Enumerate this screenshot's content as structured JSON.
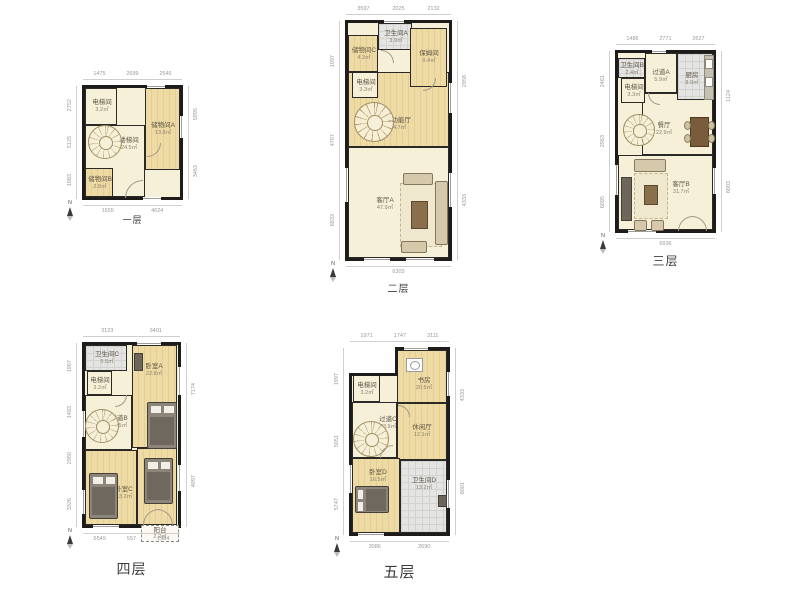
{
  "page": {
    "title": "户型图",
    "floor_count": 5
  },
  "compass_label": "N",
  "palette": {
    "wall": "#1e1c1a",
    "wood": "#eedaa5",
    "cream": "#f7f0d9",
    "tile": "#e4e4e2",
    "room_text": "#5e5646",
    "dim_text": "#9a9a98"
  },
  "floors": [
    {
      "id": "floor-1",
      "title": "一层",
      "title_style": {
        "dy": 16,
        "size": 9
      },
      "box": {
        "left": 85,
        "top": 88,
        "width": 95,
        "height": 109
      },
      "rooms": [
        {
          "key": "elevator-room",
          "name": "电梯间",
          "area": "3.2㎡",
          "x": 0,
          "y": 0,
          "w": 32,
          "h": 37,
          "fill": "cream",
          "lx": 16,
          "ly": 17
        },
        {
          "key": "storage-room-a",
          "name": "储物间A",
          "area": "13.8㎡",
          "x": 60,
          "y": 0,
          "w": 35,
          "h": 82,
          "fill": "wood",
          "lx": 77,
          "ly": 40
        },
        {
          "key": "stair-hall",
          "name": "楼梯间",
          "area": "24.5㎡",
          "x": 0,
          "y": 37,
          "w": 60,
          "h": 72,
          "fill": "cream",
          "lx": 43,
          "ly": 55
        },
        {
          "key": "storage-room-b",
          "name": "储物间B",
          "area": "2.8㎡",
          "x": 0,
          "y": 80,
          "w": 28,
          "h": 29,
          "fill": "wood",
          "lx": 14,
          "ly": 94
        }
      ],
      "stairs": {
        "cx": 19,
        "cy": 53,
        "r": 16
      },
      "furniture": [],
      "arcs": [
        {
          "x": 40,
          "y": 92,
          "r": 17,
          "rot": 0
        },
        {
          "x": 62,
          "y": 55,
          "r": 13,
          "rot": 180
        }
      ],
      "windows": [
        {
          "s": "top",
          "p": 62,
          "l": 18
        },
        {
          "s": "right",
          "p": 28,
          "l": 22
        },
        {
          "s": "bottom",
          "p": 58,
          "l": 18
        }
      ],
      "dims": {
        "top": [
          "1475",
          "2699",
          "2546"
        ],
        "bottom": [
          "1655",
          "4624"
        ],
        "left": [
          "2752",
          "5125",
          "1983"
        ],
        "right": [
          "5995",
          "3463"
        ]
      }
    },
    {
      "id": "floor-2",
      "title": "二层",
      "title_style": {
        "dy": 22,
        "size": 10
      },
      "box": {
        "left": 348,
        "top": 23,
        "width": 101,
        "height": 235
      },
      "rooms": [
        {
          "key": "multi-function-hall",
          "name": "多功能厅",
          "area": "34.7㎡",
          "x": 0,
          "y": 49,
          "w": 101,
          "h": 75,
          "fill": "wood",
          "lx": 49,
          "ly": 100
        },
        {
          "key": "living-room-a",
          "name": "客厅A",
          "area": "47.9㎡",
          "x": 0,
          "y": 124,
          "w": 101,
          "h": 111,
          "fill": "cream",
          "lx": 36,
          "ly": 180
        },
        {
          "key": "storage-room-c",
          "name": "储物间C",
          "area": "4.3㎡",
          "x": 0,
          "y": 12,
          "w": 30,
          "h": 37,
          "fill": "wood",
          "lx": 15,
          "ly": 30
        },
        {
          "key": "bathroom-a",
          "name": "卫生间A",
          "area": "3.9㎡",
          "x": 30,
          "y": 0,
          "w": 34,
          "h": 27,
          "fill": "tile",
          "lx": 47,
          "ly": 13
        },
        {
          "key": "nanny-room",
          "name": "保姆间",
          "area": "9.4㎡",
          "x": 62,
          "y": 5,
          "w": 37,
          "h": 59,
          "fill": "wood",
          "lx": 80,
          "ly": 33
        },
        {
          "key": "elevator-room",
          "name": "电梯间",
          "area": "3.3㎡",
          "x": 4,
          "y": 49,
          "w": 26,
          "h": 26,
          "fill": "cream",
          "lx": 17,
          "ly": 62
        }
      ],
      "stairs": {
        "cx": 25,
        "cy": 98,
        "r": 19
      },
      "furniture": [
        {
          "t": "rug",
          "x": 52,
          "y": 160,
          "w": 40,
          "h": 62
        },
        {
          "t": "sofa",
          "x": 55,
          "y": 150,
          "w": 28,
          "h": 10
        },
        {
          "t": "sofa",
          "x": 87,
          "y": 158,
          "w": 11,
          "h": 62
        },
        {
          "t": "sofa",
          "x": 53,
          "y": 218,
          "w": 24,
          "h": 10
        },
        {
          "t": "ctable",
          "x": 63,
          "y": 178,
          "w": 15,
          "h": 26
        }
      ],
      "arcs": [
        {
          "x": 33,
          "y": 27,
          "r": 12,
          "rot": 90
        },
        {
          "x": 75,
          "y": 55,
          "r": 12,
          "rot": 180
        }
      ],
      "windows": [
        {
          "s": "bottom",
          "p": 16,
          "l": 26
        },
        {
          "s": "bottom",
          "p": 58,
          "l": 28
        },
        {
          "s": "left",
          "p": 145,
          "l": 34
        },
        {
          "s": "right",
          "p": 60,
          "l": 30
        },
        {
          "s": "right",
          "p": 150,
          "l": 34
        },
        {
          "s": "top",
          "p": 36,
          "l": 20
        }
      ],
      "dims": {
        "top": [
          "3597",
          "2025",
          "2132"
        ],
        "bottom": [
          "6303"
        ],
        "left": [
          "1997",
          "4767",
          "6833"
        ],
        "right": [
          "2958",
          "4333"
        ]
      }
    },
    {
      "id": "floor-3",
      "title": "三层",
      "title_style": {
        "dy": 22,
        "size": 12
      },
      "box": {
        "left": 618,
        "top": 53,
        "width": 95,
        "height": 177
      },
      "rooms": [
        {
          "key": "dining-room",
          "name": "餐厅",
          "area": "22.9㎡",
          "x": 24,
          "y": 40,
          "w": 71,
          "h": 62,
          "fill": "cream",
          "lx": 45,
          "ly": 75
        },
        {
          "key": "living-room-b",
          "name": "客厅B",
          "area": "31.7㎡",
          "x": 0,
          "y": 102,
          "w": 95,
          "h": 75,
          "fill": "cream",
          "lx": 62,
          "ly": 134
        },
        {
          "key": "bathroom-b",
          "name": "卫生间B",
          "area": "2.4㎡",
          "x": 0,
          "y": 5,
          "w": 27,
          "h": 20,
          "fill": "tile",
          "lx": 13,
          "ly": 15
        },
        {
          "key": "corridor-a",
          "name": "过道A",
          "area": "5.9㎡",
          "x": 27,
          "y": 0,
          "w": 32,
          "h": 40,
          "fill": "cream",
          "lx": 42,
          "ly": 22
        },
        {
          "key": "kitchen",
          "name": "厨房",
          "area": "8.9㎡",
          "x": 59,
          "y": 0,
          "w": 36,
          "h": 47,
          "fill": "tile",
          "lx": 73,
          "ly": 25
        },
        {
          "key": "elevator-room",
          "name": "电梯间",
          "area": "3.3㎡",
          "x": 3,
          "y": 25,
          "w": 24,
          "h": 25,
          "fill": "cream",
          "lx": 15,
          "ly": 37
        }
      ],
      "stairs": {
        "cx": 20,
        "cy": 76,
        "r": 15
      },
      "furniture": [
        {
          "t": "counter",
          "x": 86,
          "y": 2,
          "w": 8,
          "h": 43
        },
        {
          "t": "appl",
          "x": 87,
          "y": 6,
          "w": 6,
          "h": 8
        },
        {
          "t": "appl",
          "x": 87,
          "y": 24,
          "w": 6,
          "h": 8
        },
        {
          "t": "dtable",
          "x": 72,
          "y": 64,
          "w": 17,
          "h": 28
        },
        {
          "t": "chair",
          "x": 66,
          "y": 68,
          "w": 5,
          "h": 7
        },
        {
          "t": "chair",
          "x": 66,
          "y": 81,
          "w": 5,
          "h": 7
        },
        {
          "t": "chair",
          "x": 90,
          "y": 68,
          "w": 5,
          "h": 7
        },
        {
          "t": "chair",
          "x": 90,
          "y": 81,
          "w": 5,
          "h": 7
        },
        {
          "t": "sofa",
          "x": 16,
          "y": 106,
          "w": 30,
          "h": 11
        },
        {
          "t": "rug",
          "x": 16,
          "y": 120,
          "w": 32,
          "h": 44
        },
        {
          "t": "ctable",
          "x": 26,
          "y": 132,
          "w": 12,
          "h": 18
        },
        {
          "t": "sofa",
          "x": 16,
          "y": 167,
          "w": 11,
          "h": 9
        },
        {
          "t": "sofa",
          "x": 33,
          "y": 167,
          "w": 11,
          "h": 9
        },
        {
          "t": "media",
          "x": 3,
          "y": 124,
          "w": 9,
          "h": 42
        }
      ],
      "arcs": [
        {
          "x": 60,
          "y": 163,
          "r": 14,
          "rot": 0
        },
        {
          "x": 74,
          "y": 163,
          "r": 14,
          "rot": 90
        },
        {
          "x": 30,
          "y": 40,
          "r": 11,
          "rot": 270
        }
      ],
      "windows": [
        {
          "s": "top",
          "p": 34,
          "l": 14
        },
        {
          "s": "bottom",
          "p": 10,
          "l": 28
        },
        {
          "s": "left",
          "p": 112,
          "l": 30
        },
        {
          "s": "right",
          "p": 115,
          "l": 26
        }
      ],
      "dims": {
        "top": [
          "1486",
          "2771",
          "2627"
        ],
        "bottom": [
          "6936"
        ],
        "left": [
          "2461",
          "2963",
          "6095"
        ],
        "right": [
          "1124",
          "8003"
        ]
      }
    },
    {
      "id": "floor-4",
      "title": "四层",
      "title_style": {
        "dy": 34,
        "size": 14
      },
      "box": {
        "left": 85,
        "top": 345,
        "width": 93,
        "height": 180
      },
      "rooms": [
        {
          "key": "bedroom-a",
          "name": "卧室A",
          "area": "22.8㎡",
          "x": 47,
          "y": 0,
          "w": 45,
          "h": 103,
          "fill": "wood",
          "lx": 68,
          "ly": 24
        },
        {
          "key": "corridor-b",
          "name": "过道B",
          "area": "24.5㎡",
          "x": 0,
          "y": 50,
          "w": 47,
          "h": 55,
          "fill": "cream",
          "lx": 33,
          "ly": 76
        },
        {
          "key": "bedroom-c",
          "name": "卧室C",
          "area": "13.2㎡",
          "x": 0,
          "y": 105,
          "w": 52,
          "h": 75,
          "fill": "wood",
          "lx": 38,
          "ly": 147
        },
        {
          "key": "bedroom-b",
          "name": "卧室B",
          "area": "13.4㎡",
          "x": 52,
          "y": 103,
          "w": 40,
          "h": 77,
          "fill": "wood",
          "lx": 70,
          "ly": 121
        },
        {
          "key": "bathroom-c",
          "name": "卫生间C",
          "area": "5.5㎡",
          "x": 0,
          "y": 0,
          "w": 42,
          "h": 26,
          "fill": "tile",
          "lx": 21,
          "ly": 12
        },
        {
          "key": "elevator-room",
          "name": "电梯间",
          "area": "3.2㎡",
          "x": 2,
          "y": 26,
          "w": 25,
          "h": 24,
          "fill": "cream",
          "lx": 14,
          "ly": 38
        }
      ],
      "stairs": {
        "cx": 16,
        "cy": 80,
        "r": 16
      },
      "furniture": [
        {
          "t": "bed",
          "o": "v",
          "x": 62,
          "y": 57,
          "w": 28,
          "h": 45
        },
        {
          "t": "bed",
          "o": "v",
          "x": 4,
          "y": 128,
          "w": 27,
          "h": 44
        },
        {
          "t": "bed",
          "o": "v",
          "x": 59,
          "y": 113,
          "w": 27,
          "h": 44
        },
        {
          "t": "media",
          "x": 49,
          "y": 8,
          "w": 7,
          "h": 16
        }
      ],
      "balcony": {
        "name": "阳台",
        "area": "2.2㎡",
        "x": 56,
        "y": 180,
        "w": 36,
        "h": 15
      },
      "arcs": [
        {
          "x": 58,
          "y": 164,
          "r": 15,
          "rot": 0
        },
        {
          "x": 72,
          "y": 164,
          "r": 15,
          "rot": 90
        },
        {
          "x": 30,
          "y": 50,
          "r": 11,
          "rot": 180
        }
      ],
      "windows": [
        {
          "s": "top",
          "p": 52,
          "l": 24
        },
        {
          "s": "left",
          "p": 66,
          "l": 26
        },
        {
          "s": "left",
          "p": 145,
          "l": 24
        },
        {
          "s": "right",
          "p": 22,
          "l": 28
        },
        {
          "s": "right",
          "p": 120,
          "l": 26
        },
        {
          "s": "bottom",
          "p": 8,
          "l": 26
        }
      ],
      "dims": {
        "top": [
          "3123",
          "3401"
        ],
        "bottom": [
          "5549",
          "557",
          "1984"
        ],
        "left": [
          "1967",
          "1483",
          "2960",
          "3326"
        ],
        "right": [
          "7174",
          "4997"
        ]
      }
    },
    {
      "id": "floor-5",
      "title": "五层",
      "title_style": {
        "dy": 28,
        "size": 15
      },
      "box": {
        "left": 352,
        "top": 350,
        "width": 95,
        "height": 183
      },
      "rooms": [
        {
          "key": "study-room",
          "name": "书房",
          "area": "20.5㎡",
          "x": 45,
          "y": 0,
          "w": 50,
          "h": 53,
          "fill": "wood",
          "lx": 71,
          "ly": 33
        },
        {
          "key": "lounge",
          "name": "休闲厅",
          "area": "12.1㎡",
          "x": 45,
          "y": 53,
          "w": 50,
          "h": 57,
          "fill": "wood",
          "lx": 69,
          "ly": 80
        },
        {
          "key": "corridor-c",
          "name": "过道C",
          "area": "23.9㎡",
          "x": 0,
          "y": 52,
          "w": 45,
          "h": 56,
          "fill": "cream",
          "lx": 35,
          "ly": 72
        },
        {
          "key": "bedroom-d",
          "name": "卧室D",
          "area": "16.5㎡",
          "x": 0,
          "y": 108,
          "w": 48,
          "h": 75,
          "fill": "wood",
          "lx": 25,
          "ly": 125
        },
        {
          "key": "bathroom-d",
          "name": "卫生间D",
          "area": "13.2㎡",
          "x": 48,
          "y": 110,
          "w": 47,
          "h": 73,
          "fill": "tile",
          "lx": 71,
          "ly": 133
        },
        {
          "key": "elevator-room",
          "name": "电梯间",
          "area": "3.2㎡",
          "x": 1,
          "y": 25,
          "w": 27,
          "h": 27,
          "fill": "cream",
          "lx": 14,
          "ly": 38
        },
        {
          "key": "wall-notch",
          "mask": true,
          "x": -3,
          "y": -3,
          "w": 46,
          "h": 26
        }
      ],
      "stairs": {
        "cx": 18,
        "cy": 88,
        "r": 17
      },
      "furniture": [
        {
          "t": "washer",
          "x": 54,
          "y": 8,
          "w": 15,
          "h": 12
        },
        {
          "t": "bed",
          "o": "h",
          "x": 3,
          "y": 136,
          "w": 32,
          "h": 25
        },
        {
          "t": "media",
          "x": 86,
          "y": 145,
          "w": 7,
          "h": 10
        }
      ],
      "arcs": [
        {
          "x": 28,
          "y": 95,
          "r": 12,
          "rot": 0
        },
        {
          "x": 46,
          "y": 55,
          "r": 11,
          "rot": 90
        }
      ],
      "windows": [
        {
          "s": "top",
          "p": 52,
          "l": 24
        },
        {
          "s": "left",
          "p": 115,
          "l": 28
        },
        {
          "s": "right",
          "p": 22,
          "l": 24
        },
        {
          "s": "right",
          "p": 130,
          "l": 28
        },
        {
          "s": "bottom",
          "p": 6,
          "l": 26
        }
      ],
      "dims": {
        "top": [
          "1971",
          "1747",
          "3111"
        ],
        "bottom": [
          "3086",
          "2690"
        ],
        "left": [
          "1997",
          "5051",
          "5747"
        ],
        "right": [
          "4333",
          "8001"
        ]
      }
    }
  ]
}
